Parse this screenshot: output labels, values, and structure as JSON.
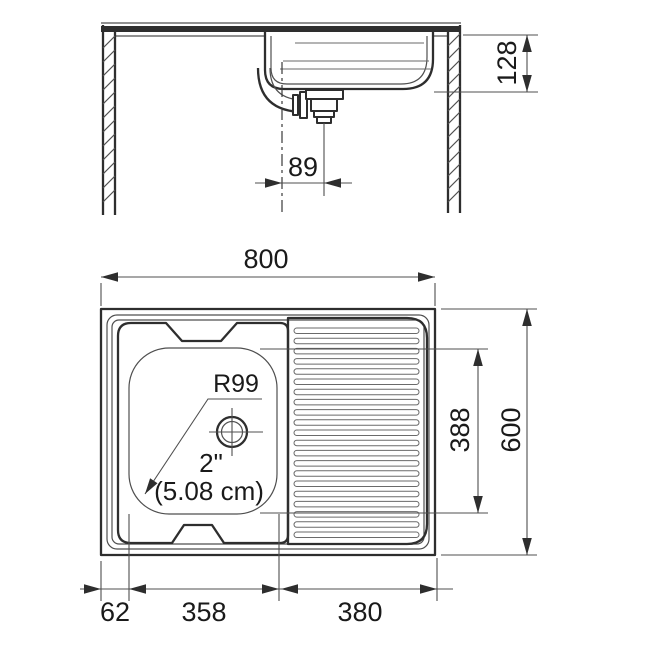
{
  "figure": {
    "kind": "sink-technical-drawing",
    "section_view": {
      "dim_bowl_depth": "128",
      "dim_drain_offset": "89"
    },
    "plan_view": {
      "dim_overall_width": "800",
      "dim_overall_depth": "600",
      "dim_bowl_span": "388",
      "dim_edge_offset": "62",
      "dim_bowl_width": "358",
      "dim_drainboard_width": "380",
      "label_corner_radius": "R99",
      "label_drain_size_in": "2\"",
      "label_drain_size_cm": "(5.08 cm)",
      "drainboard_rib_count": 21
    },
    "colors": {
      "line": "#2e2e2e",
      "thin_line": "#4f4f4f",
      "text": "#1a1a1a",
      "background": "#ffffff"
    }
  }
}
